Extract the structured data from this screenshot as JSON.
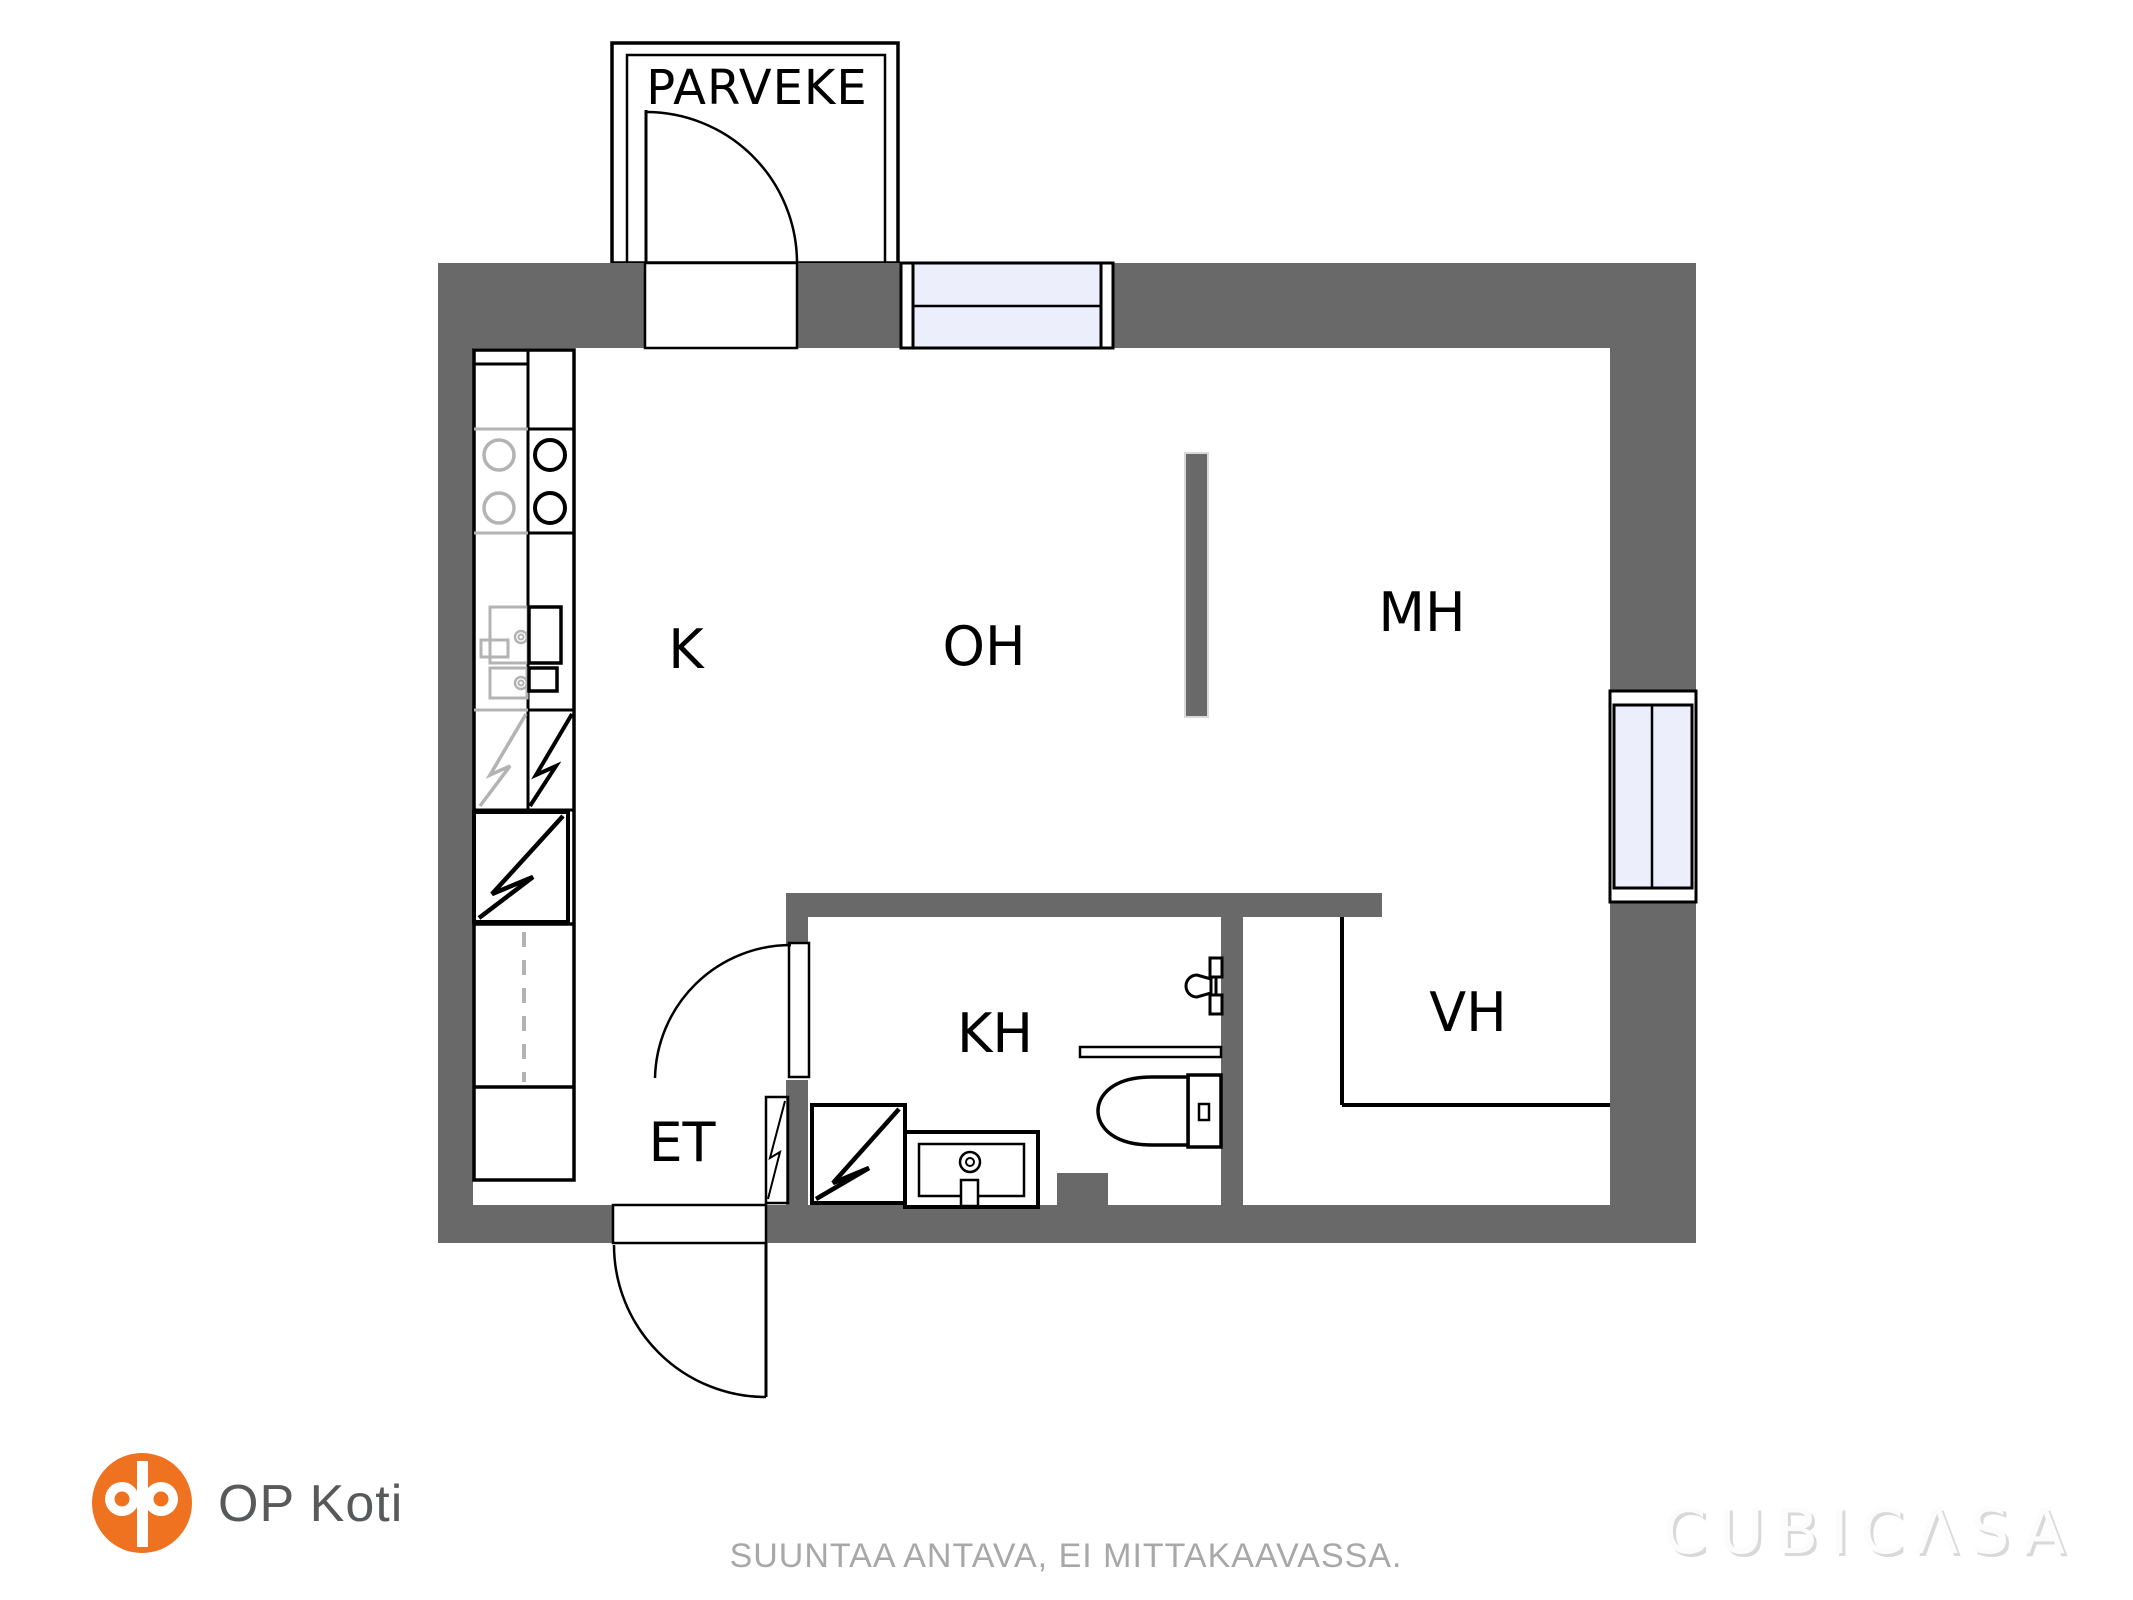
{
  "rooms": {
    "balcony": "PARVEKE",
    "kitchen": "K",
    "living_room": "OH",
    "bedroom": "MH",
    "bathroom": "KH",
    "closet": "VH",
    "entry": "ET"
  },
  "branding": {
    "company": "OP Koti",
    "watermark": "CUBICΛSA"
  },
  "footer": {
    "disclaimer": "SUUNTAA ANTAVA, EI MITTAKAAVASSA."
  },
  "fixtures": [
    "stove-burners",
    "kitchen-sink",
    "dishwasher",
    "fridge-symbol",
    "freezer-symbol",
    "tall-cabinet-dashed",
    "washing-machine",
    "bathroom-sink",
    "toilet",
    "shower-rail",
    "shower-faucet"
  ],
  "colors": {
    "wall": "#696969",
    "window_fill": "#edeefb",
    "fixture_gray": "#b3b3b3",
    "brand_orange": "#ee7220",
    "brand_text": "#58595b",
    "disclaimer_text": "#a8a8a8",
    "watermark_fill": "#fcfcfc",
    "watermark_shadow": "#d9d9d9"
  }
}
